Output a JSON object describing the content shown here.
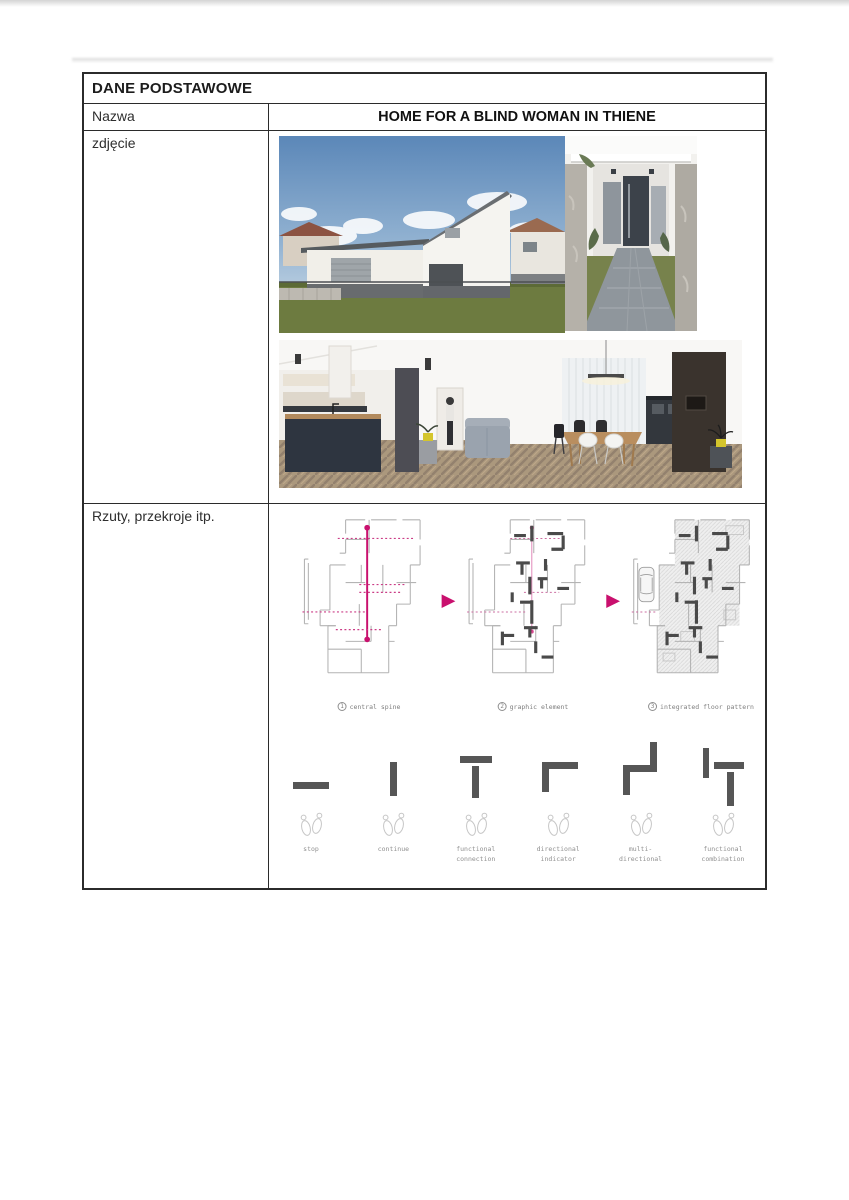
{
  "table": {
    "header": "DANE PODSTAWOWE",
    "nazwa_label": "Nazwa",
    "nazwa_value": "HOME FOR A BLIND WOMAN IN THIENE",
    "zdjecie_label": "zdjęcie",
    "rzuty_label": "Rzuty, przekroje itp."
  },
  "diagrams": {
    "captions": [
      {
        "num": "1",
        "text": "central spine"
      },
      {
        "num": "2",
        "text": "graphic element"
      },
      {
        "num": "3",
        "text": "integrated floor pattern"
      }
    ],
    "symbols": [
      {
        "label": "stop"
      },
      {
        "label": "continue"
      },
      {
        "label": "functional\nconnection"
      },
      {
        "label": "directional\nindicator"
      },
      {
        "label": "multi-\ndirectional"
      },
      {
        "label": "functional\ncombination"
      }
    ]
  },
  "colors": {
    "accent_magenta": "#c9106e",
    "plan_wall_gray": "#b4b4b4",
    "tactile_bar_gray": "#565656",
    "table_border": "#2b2b2b"
  }
}
